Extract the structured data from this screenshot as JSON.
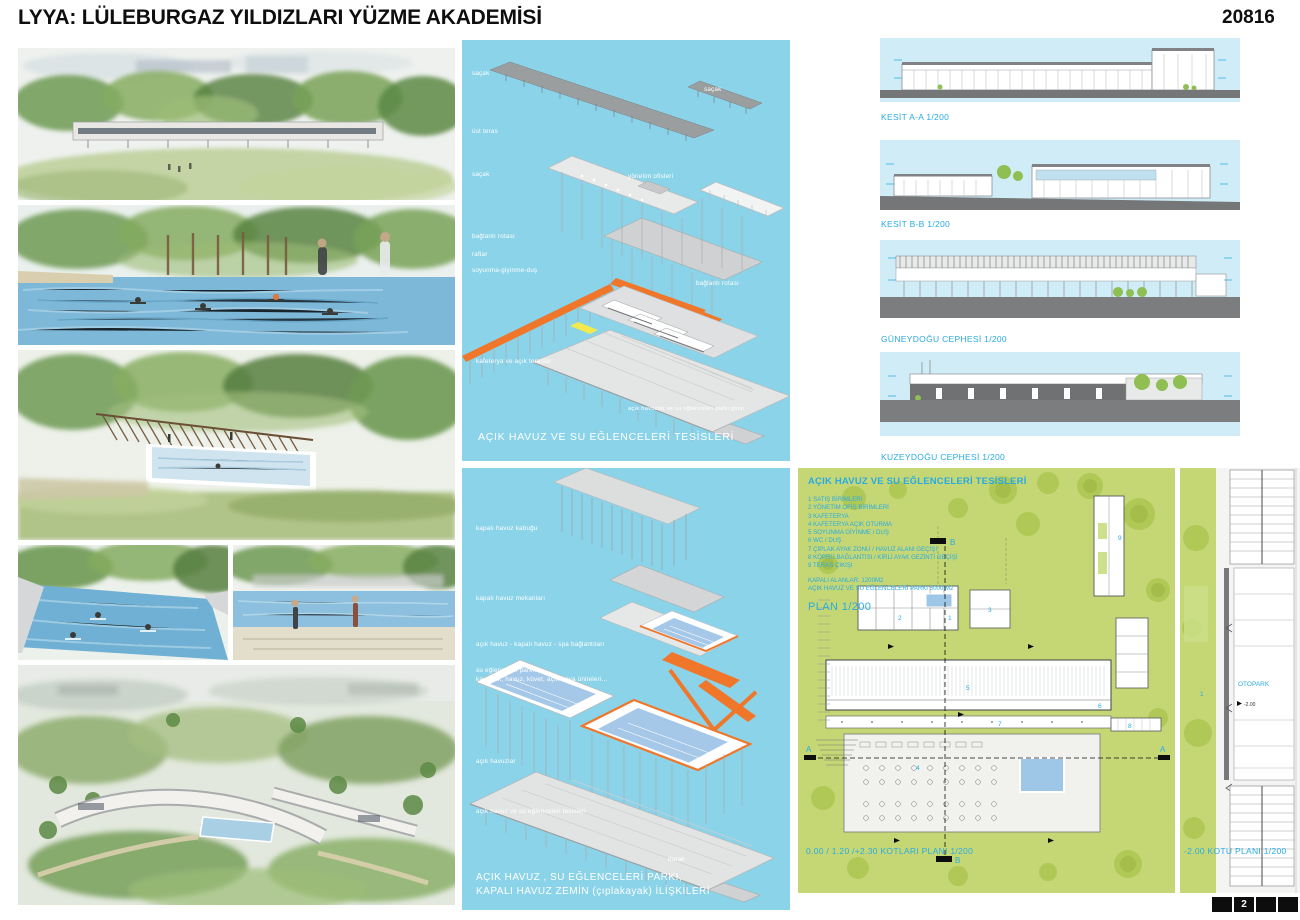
{
  "header": {
    "title": "LYYA: LÜLEBURGAZ YILDIZLARI YÜZME AKADEMİSİ",
    "entry_number": "20816"
  },
  "colors": {
    "accent_blue": "#29abe2",
    "panel_blue": "#8bd3e9",
    "section_sky": "#cfecf7",
    "accent_orange": "#f0762a",
    "plan_green": "#c5d775",
    "tree_green": "#aec753",
    "pool_blue": "#9ec6e6"
  },
  "diagram_top": {
    "labels": [
      {
        "text": "saçak"
      },
      {
        "text": "üst teras"
      },
      {
        "text": "saçak"
      },
      {
        "text": "bağlantı rotası"
      },
      {
        "text": "raflar"
      },
      {
        "text": "soyunma-giyinme-duş"
      },
      {
        "text": "kafeterya ve açık teraslar"
      },
      {
        "text": "saçak"
      },
      {
        "text": "yönetim ofisleri"
      },
      {
        "text": "bağlantı rotası"
      },
      {
        "text": "açık havuzlar ve su eğlenceleri parkı girişi"
      }
    ],
    "caption": "AÇIK HAVUZ VE SU EĞLENCELERİ TESİSLERİ"
  },
  "diagram_bottom": {
    "labels": [
      {
        "text": "kapalı havuz kabuğu"
      },
      {
        "text": "kapalı havuz mekanları"
      },
      {
        "text": "açık havuz - kapalı havuz - spa bağlantıları"
      },
      {
        "text": "su eğlenceleri parkı:"
      },
      {
        "text": "kaydırak, havuz, küvet, açık hava üniteleri..."
      },
      {
        "text": "açık havuzlar"
      },
      {
        "text": "açık havuz ve su eğlenceleri tesisleri"
      },
      {
        "text": "durak"
      }
    ],
    "caption_line1": "AÇIK HAVUZ , SU EĞLENCELERİ PARKI,",
    "caption_line2": "KAPALI HAVUZ ZEMİN  (çıplakayak) İLİŞKİLERİ"
  },
  "sections": [
    {
      "label": "KESİT A-A 1/200"
    },
    {
      "label": "KESİT B-B 1/200"
    },
    {
      "label": "GÜNEYDOĞU CEPHESİ 1/200"
    },
    {
      "label": "KUZEYDOĞU CEPHESİ 1/200"
    }
  ],
  "plan_main": {
    "heading": "AÇIK HAVUZ VE SU EĞLENCELERİ TESİSLERİ",
    "legend": [
      "1 SATIŞ BİRİMLERİ",
      "2 YÖNETİM  OFİS BİRİMLERİ",
      "3 KAFETERYA",
      "4 KAFETERYA AÇIK OTURMA",
      "5 SOYUNMA GİYİNME / DUŞ",
      "6  WC / DUŞ",
      "7 ÇIPLAK AYAK ZONU / HAVUZ ALANI GEÇİŞİ",
      "8 KÖPRÜ  BAĞLANTISI /  KİRLİ AYAK GEZİNTİ GEÇİŞİ",
      "9 TERAS ÇIKIŞI"
    ],
    "areas": [
      "KAPALI ALANLAR: 1200M2",
      "AÇIK HAVUZ VE SU EĞLENCELERİ PARKI  5000 M2"
    ],
    "plan_label": "PLAN 1/200",
    "caption": "0.00 / 1.20 /+2.30  KOTLARI PLANI 1/200",
    "marker_a": "A",
    "marker_b": "B",
    "numbers": [
      "1",
      "2",
      "3",
      "4",
      "5",
      "6",
      "7",
      "8",
      "9"
    ]
  },
  "plan_parking": {
    "label": "OTOPARK",
    "level": "-2.00",
    "annotation": "1",
    "caption": "-2.00  KOTU PLANI 1/200"
  },
  "pager": {
    "page": "2"
  }
}
